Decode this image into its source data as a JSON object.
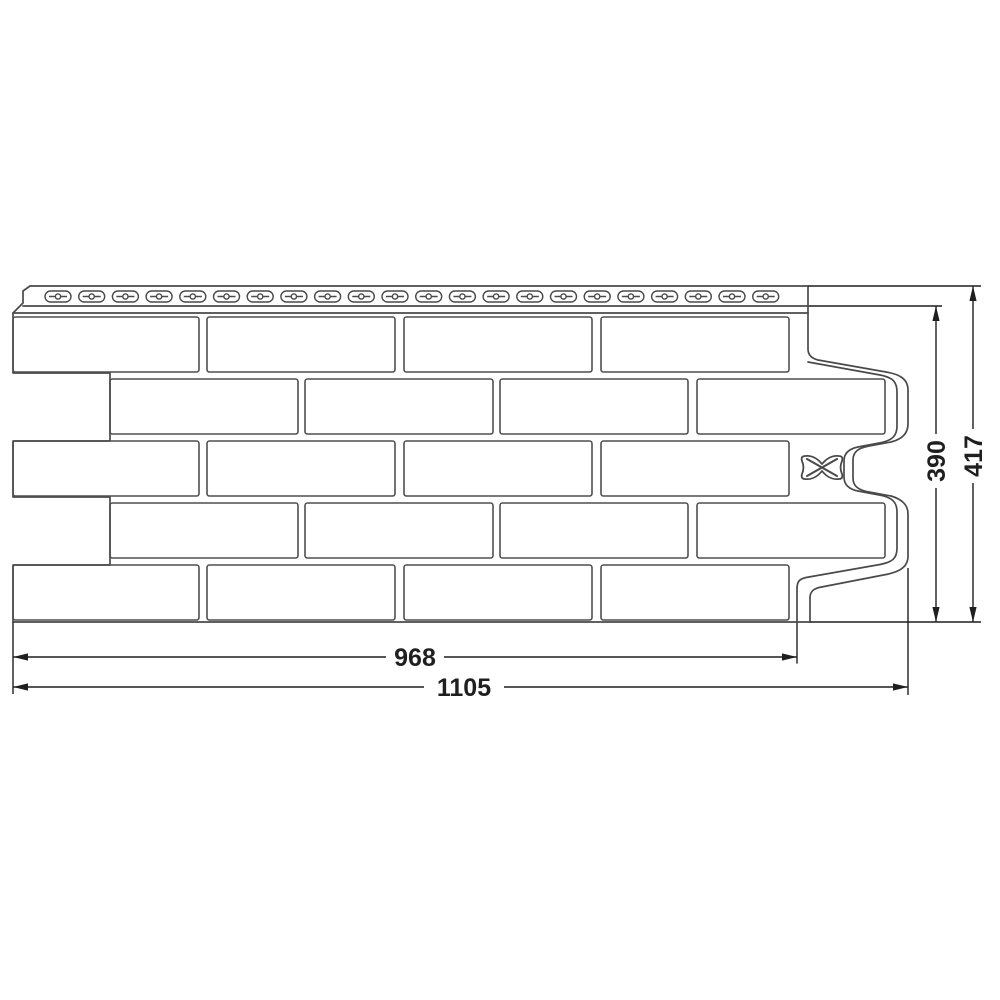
{
  "drawing": {
    "title": "facade-panel-dimension-drawing",
    "background": "#ffffff",
    "line_color": "#4a4a4a",
    "brick_line_color": "#4f4f4f",
    "dim_color": "#1f1f1f"
  },
  "dimensions": {
    "overall_width": {
      "label": "1105",
      "value": 1105
    },
    "working_width": {
      "label": "968",
      "value": 968
    },
    "working_height": {
      "label": "390",
      "value": 390
    },
    "overall_height": {
      "label": "417",
      "value": 417
    }
  },
  "panel": {
    "nail_slot_count": 22,
    "brick_row_count": 5,
    "bricks_per_row": 4,
    "mark": "butterfly-lock"
  }
}
